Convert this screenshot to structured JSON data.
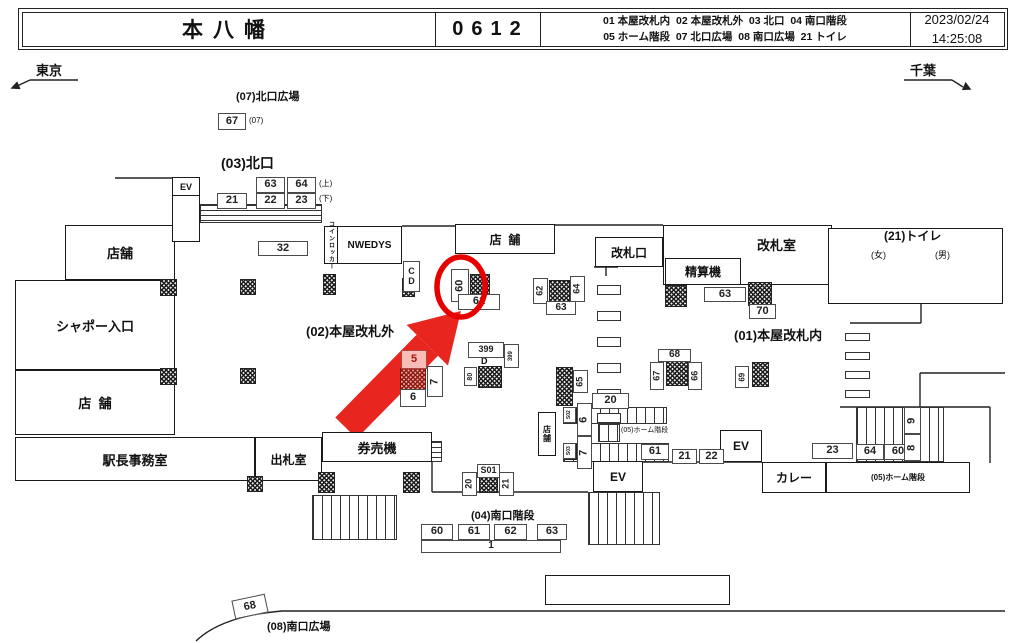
{
  "header": {
    "station": "本八幡",
    "code": "0612",
    "legend_line1": "01 本屋改札内  02 本屋改札外  03 北口  04 南口階段",
    "legend_line2": "05 ホーム階段  07 北口広場  08 南口広場  21 トイレ",
    "date": "2023/02/24",
    "time": "14:25:08"
  },
  "directions": {
    "left": "東京",
    "right": "千葉"
  },
  "colors": {
    "arrow_red": "#e8251f",
    "circle_red": "#e60000",
    "line": "#222222"
  },
  "map": {
    "labels": [
      {
        "n": "label-north-plaza",
        "t": "(07)北口広場",
        "x": 236,
        "y": 91,
        "s": 11,
        "b": 1
      },
      {
        "n": "label-sub-07",
        "t": "(07)",
        "x": 249,
        "y": 117,
        "s": 8
      },
      {
        "n": "label-north-exit",
        "t": "(03)北口",
        "x": 221,
        "y": 156,
        "s": 14,
        "b": 1
      },
      {
        "n": "label-upper",
        "t": "(上)",
        "x": 319,
        "y": 180,
        "s": 8
      },
      {
        "n": "label-lower",
        "t": "(下)",
        "x": 319,
        "y": 195,
        "s": 8
      },
      {
        "n": "label-outside-gates",
        "t": "(02)本屋改札外",
        "x": 306,
        "y": 325,
        "s": 13,
        "b": 1
      },
      {
        "n": "label-inside-gates",
        "t": "(01)本屋改札内",
        "x": 734,
        "y": 329,
        "s": 13,
        "b": 1
      },
      {
        "n": "label-toilet",
        "t": "(21)トイレ",
        "x": 884,
        "y": 230,
        "s": 12,
        "b": 1
      },
      {
        "n": "label-women",
        "t": "(女)",
        "x": 871,
        "y": 251,
        "s": 9
      },
      {
        "n": "label-men",
        "t": "(男)",
        "x": 935,
        "y": 251,
        "s": 9
      },
      {
        "n": "label-gate-room",
        "t": "改札室",
        "x": 757,
        "y": 239,
        "s": 13,
        "b": 1
      },
      {
        "n": "label-home-stairs-center",
        "t": "(05)ホーム階段",
        "x": 621,
        "y": 427,
        "s": 7,
        "bg": 1
      },
      {
        "n": "label-south-stairs",
        "t": "(04)南口階段",
        "x": 471,
        "y": 510,
        "s": 11,
        "b": 1
      },
      {
        "n": "label-south-plaza",
        "t": "(08)南口広場",
        "x": 267,
        "y": 621,
        "s": 11,
        "b": 1
      },
      {
        "n": "label-d",
        "t": "D",
        "x": 481,
        "y": 357,
        "s": 9,
        "b": 1
      }
    ],
    "rooms": [
      {
        "n": "room-shop-a",
        "t": "店舗",
        "x": 65,
        "y": 225,
        "w": 110,
        "h": 55,
        "s": 13
      },
      {
        "n": "room-chapeau-entrance",
        "t": "シャポー入口",
        "x": 15,
        "y": 280,
        "w": 160,
        "h": 90,
        "s": 13
      },
      {
        "n": "room-shop-b",
        "t": "店  舗",
        "x": 15,
        "y": 370,
        "w": 160,
        "h": 65,
        "s": 13
      },
      {
        "n": "room-stationmaster-office",
        "t": "駅長事務室",
        "x": 15,
        "y": 437,
        "w": 240,
        "h": 44,
        "s": 13
      },
      {
        "n": "room-ticket-window",
        "t": "出札室",
        "x": 255,
        "y": 437,
        "w": 67,
        "h": 44,
        "s": 12
      },
      {
        "n": "room-ticket-machines",
        "t": "券売機",
        "x": 322,
        "y": 432,
        "w": 110,
        "h": 30,
        "s": 13
      },
      {
        "n": "room-nwedys",
        "t": "NWEDYS",
        "x": 337,
        "y": 226,
        "w": 65,
        "h": 38,
        "s": 10
      },
      {
        "n": "room-shop-c",
        "t": "店  舗",
        "x": 455,
        "y": 224,
        "w": 100,
        "h": 30,
        "s": 12
      },
      {
        "n": "room-gate",
        "t": "改札口",
        "x": 595,
        "y": 237,
        "w": 68,
        "h": 30,
        "s": 12
      },
      {
        "n": "room-gate-office",
        "t": "",
        "x": 663,
        "y": 225,
        "w": 169,
        "h": 60
      },
      {
        "n": "room-fare-adjustment",
        "t": "精算機",
        "x": 665,
        "y": 258,
        "w": 76,
        "h": 27,
        "s": 12
      },
      {
        "n": "room-toilet",
        "t": "",
        "x": 828,
        "y": 228,
        "w": 175,
        "h": 76
      },
      {
        "n": "room-ev-north",
        "t": "EV",
        "x": 172,
        "y": 177,
        "w": 28,
        "h": 19,
        "s": 9
      },
      {
        "n": "room-ev-shaft",
        "t": "",
        "x": 172,
        "y": 195,
        "w": 28,
        "h": 47
      },
      {
        "n": "room-ev-center",
        "t": "EV",
        "x": 593,
        "y": 461,
        "w": 50,
        "h": 31,
        "s": 12
      },
      {
        "n": "room-ev-right",
        "t": "EV",
        "x": 720,
        "y": 430,
        "w": 42,
        "h": 32,
        "s": 12
      },
      {
        "n": "room-curry",
        "t": "カレー",
        "x": 762,
        "y": 462,
        "w": 64,
        "h": 31,
        "s": 12
      },
      {
        "n": "room-home-stairs-05",
        "t": "(05)ホーム階段",
        "x": 826,
        "y": 462,
        "w": 144,
        "h": 31,
        "s": 8
      },
      {
        "n": "room-south-rect",
        "t": "",
        "x": 545,
        "y": 575,
        "w": 185,
        "h": 30
      },
      {
        "n": "room-coin-locker",
        "t": "コインロッカー",
        "x": 324,
        "y": 226,
        "w": 14,
        "h": 38,
        "s": 6,
        "vl": 1
      },
      {
        "n": "room-shop-small",
        "t": "店舗",
        "x": 538,
        "y": 412,
        "w": 18,
        "h": 44,
        "s": 8,
        "vl": 1
      }
    ],
    "boxes": [
      {
        "t": "67",
        "x": 218,
        "y": 113,
        "w": 28,
        "h": 17
      },
      {
        "t": "63",
        "x": 256,
        "y": 177,
        "w": 29,
        "h": 16
      },
      {
        "t": "64",
        "x": 287,
        "y": 177,
        "w": 29,
        "h": 16
      },
      {
        "t": "21",
        "x": 217,
        "y": 193,
        "w": 30,
        "h": 16
      },
      {
        "t": "22",
        "x": 256,
        "y": 193,
        "w": 29,
        "h": 16
      },
      {
        "t": "23",
        "x": 287,
        "y": 193,
        "w": 29,
        "h": 16
      },
      {
        "t": "32",
        "x": 258,
        "y": 241,
        "w": 50,
        "h": 15
      },
      {
        "t": "C\nD",
        "x": 403,
        "y": 261,
        "w": 17,
        "h": 31,
        "s": 9
      },
      {
        "t": "60",
        "x": 451,
        "y": 269,
        "w": 18,
        "h": 33,
        "v": 1
      },
      {
        "t": "61",
        "x": 458,
        "y": 294,
        "w": 42,
        "h": 16
      },
      {
        "t": "399",
        "x": 468,
        "y": 342,
        "w": 36,
        "h": 16,
        "s": 9
      },
      {
        "t": "399",
        "x": 504,
        "y": 344,
        "w": 15,
        "h": 24,
        "v": 1,
        "s": 6
      },
      {
        "t": "80",
        "x": 464,
        "y": 367,
        "w": 13,
        "h": 19,
        "v": 1,
        "s": 7
      },
      {
        "t": "5",
        "x": 401,
        "y": 350,
        "w": 26,
        "h": 19,
        "red": 1
      },
      {
        "t": "7",
        "x": 427,
        "y": 366,
        "w": 16,
        "h": 31,
        "v": 1
      },
      {
        "t": "6",
        "x": 400,
        "y": 389,
        "w": 26,
        "h": 18
      },
      {
        "t": "62",
        "x": 533,
        "y": 278,
        "w": 15,
        "h": 26,
        "v": 1,
        "s": 9
      },
      {
        "t": "64",
        "x": 570,
        "y": 276,
        "w": 15,
        "h": 26,
        "v": 1,
        "s": 9
      },
      {
        "t": "63",
        "x": 546,
        "y": 301,
        "w": 30,
        "h": 14,
        "s": 10
      },
      {
        "t": "63",
        "x": 704,
        "y": 287,
        "w": 42,
        "h": 15
      },
      {
        "t": "70",
        "x": 749,
        "y": 304,
        "w": 27,
        "h": 15
      },
      {
        "t": "68",
        "x": 658,
        "y": 349,
        "w": 33,
        "h": 13,
        "s": 10
      },
      {
        "t": "67",
        "x": 650,
        "y": 362,
        "w": 14,
        "h": 28,
        "v": 1,
        "s": 9
      },
      {
        "t": "66",
        "x": 688,
        "y": 362,
        "w": 14,
        "h": 28,
        "v": 1,
        "s": 9
      },
      {
        "t": "69",
        "x": 735,
        "y": 366,
        "w": 14,
        "h": 22,
        "v": 1,
        "s": 8
      },
      {
        "t": "65",
        "x": 573,
        "y": 370,
        "w": 15,
        "h": 23,
        "v": 1,
        "s": 9
      },
      {
        "t": "20",
        "x": 592,
        "y": 393,
        "w": 37,
        "h": 16
      },
      {
        "t": "S02",
        "x": 563,
        "y": 407,
        "w": 13,
        "h": 16,
        "v": 1,
        "s": 5
      },
      {
        "t": "6",
        "x": 577,
        "y": 403,
        "w": 15,
        "h": 33,
        "v": 1
      },
      {
        "t": "S03",
        "x": 563,
        "y": 443,
        "w": 13,
        "h": 16,
        "v": 1,
        "s": 5
      },
      {
        "t": "7",
        "x": 577,
        "y": 436,
        "w": 15,
        "h": 33,
        "v": 1
      },
      {
        "t": "61",
        "x": 641,
        "y": 444,
        "w": 28,
        "h": 16
      },
      {
        "t": "21",
        "x": 672,
        "y": 449,
        "w": 25,
        "h": 15
      },
      {
        "t": "22",
        "x": 699,
        "y": 449,
        "w": 25,
        "h": 15
      },
      {
        "t": "23",
        "x": 812,
        "y": 443,
        "w": 41,
        "h": 16
      },
      {
        "t": "64",
        "x": 856,
        "y": 444,
        "w": 28,
        "h": 16
      },
      {
        "t": "60",
        "x": 884,
        "y": 444,
        "w": 28,
        "h": 16
      },
      {
        "t": "9",
        "x": 904,
        "y": 407,
        "w": 17,
        "h": 27,
        "v": 1
      },
      {
        "t": "8",
        "x": 904,
        "y": 434,
        "w": 17,
        "h": 27,
        "v": 1
      },
      {
        "t": "S01",
        "x": 477,
        "y": 464,
        "w": 23,
        "h": 14,
        "s": 9
      },
      {
        "t": "20",
        "x": 462,
        "y": 472,
        "w": 15,
        "h": 24,
        "v": 1,
        "s": 9
      },
      {
        "t": "21",
        "x": 499,
        "y": 472,
        "w": 15,
        "h": 24,
        "v": 1,
        "s": 9
      },
      {
        "t": "60",
        "x": 421,
        "y": 524,
        "w": 32,
        "h": 16
      },
      {
        "t": "61",
        "x": 458,
        "y": 524,
        "w": 32,
        "h": 16
      },
      {
        "t": "62",
        "x": 494,
        "y": 524,
        "w": 33,
        "h": 16
      },
      {
        "t": "63",
        "x": 537,
        "y": 524,
        "w": 30,
        "h": 16
      },
      {
        "t": "1",
        "x": 421,
        "y": 540,
        "w": 140,
        "h": 13,
        "s": 10
      },
      {
        "t": "68",
        "x": 233,
        "y": 597,
        "w": 34,
        "h": 19,
        "rot": -12
      }
    ],
    "hatches": [
      {
        "x": 160,
        "y": 279,
        "w": 17,
        "h": 17
      },
      {
        "x": 240,
        "y": 279,
        "w": 16,
        "h": 16
      },
      {
        "x": 323,
        "y": 274,
        "w": 13,
        "h": 21
      },
      {
        "x": 402,
        "y": 278,
        "w": 13,
        "h": 19
      },
      {
        "x": 160,
        "y": 368,
        "w": 17,
        "h": 17
      },
      {
        "x": 240,
        "y": 368,
        "w": 16,
        "h": 16
      },
      {
        "x": 247,
        "y": 476,
        "w": 16,
        "h": 16
      },
      {
        "x": 470,
        "y": 274,
        "w": 20,
        "h": 23
      },
      {
        "x": 478,
        "y": 366,
        "w": 24,
        "h": 22
      },
      {
        "x": 549,
        "y": 280,
        "w": 21,
        "h": 22
      },
      {
        "x": 665,
        "y": 285,
        "w": 22,
        "h": 22
      },
      {
        "x": 748,
        "y": 282,
        "w": 24,
        "h": 24
      },
      {
        "x": 666,
        "y": 361,
        "w": 22,
        "h": 25
      },
      {
        "x": 752,
        "y": 362,
        "w": 17,
        "h": 25
      },
      {
        "x": 556,
        "y": 367,
        "w": 17,
        "h": 39
      },
      {
        "x": 318,
        "y": 472,
        "w": 17,
        "h": 21
      },
      {
        "x": 403,
        "y": 472,
        "w": 17,
        "h": 21
      },
      {
        "x": 479,
        "y": 477,
        "w": 19,
        "h": 16
      },
      {
        "x": 565,
        "y": 408,
        "w": 12,
        "h": 15
      },
      {
        "x": 565,
        "y": 444,
        "w": 12,
        "h": 16
      },
      {
        "x": 400,
        "y": 368,
        "w": 26,
        "h": 22,
        "red": 1
      }
    ],
    "gates": [
      {
        "x": 597,
        "y": 285,
        "w": 24,
        "h": 10
      },
      {
        "x": 597,
        "y": 311,
        "w": 24,
        "h": 10
      },
      {
        "x": 597,
        "y": 337,
        "w": 24,
        "h": 10
      },
      {
        "x": 597,
        "y": 363,
        "w": 24,
        "h": 10
      },
      {
        "x": 597,
        "y": 389,
        "w": 24,
        "h": 10
      },
      {
        "x": 597,
        "y": 413,
        "w": 24,
        "h": 10
      },
      {
        "x": 845,
        "y": 333,
        "w": 25,
        "h": 8
      },
      {
        "x": 845,
        "y": 352,
        "w": 25,
        "h": 8
      },
      {
        "x": 845,
        "y": 371,
        "w": 25,
        "h": 8
      },
      {
        "x": 845,
        "y": 390,
        "w": 25,
        "h": 8
      }
    ],
    "stairs": [
      {
        "x": 200,
        "y": 204,
        "w": 122,
        "h": 19,
        "dir": "h"
      },
      {
        "x": 312,
        "y": 495,
        "w": 85,
        "h": 45,
        "dir": "v"
      },
      {
        "x": 588,
        "y": 492,
        "w": 72,
        "h": 53,
        "dir": "v"
      },
      {
        "x": 856,
        "y": 407,
        "w": 88,
        "h": 55,
        "dir": "v"
      },
      {
        "x": 563,
        "y": 407,
        "w": 104,
        "h": 17,
        "dir": "v"
      },
      {
        "x": 563,
        "y": 443,
        "w": 106,
        "h": 19,
        "dir": "v"
      },
      {
        "x": 598,
        "y": 424,
        "w": 22,
        "h": 18,
        "dir": "v"
      },
      {
        "x": 429,
        "y": 441,
        "w": 13,
        "h": 21,
        "dir": "h"
      }
    ],
    "walls": [
      [
        115,
        178,
        172,
        178
      ],
      [
        402,
        226,
        455,
        226
      ],
      [
        555,
        225,
        663,
        225
      ],
      [
        916,
        241,
        916,
        276
      ],
      [
        850,
        276,
        975,
        276
      ],
      [
        850,
        323,
        921,
        323
      ],
      [
        921,
        304,
        921,
        323
      ],
      [
        920,
        373,
        1005,
        373
      ],
      [
        920,
        373,
        920,
        407
      ],
      [
        840,
        407,
        990,
        407
      ],
      [
        990,
        407,
        990,
        463
      ],
      [
        432,
        462,
        432,
        492
      ],
      [
        432,
        492,
        588,
        492
      ],
      [
        643,
        462,
        762,
        462
      ],
      [
        594,
        267,
        618,
        267
      ],
      [
        606,
        267,
        606,
        276
      ]
    ],
    "highlight": {
      "circle": {
        "cx": 461,
        "cy": 287,
        "rx": 24,
        "ry": 30,
        "stroke_w": 5.5
      },
      "arrow": {
        "x": 346,
        "y": 428,
        "angle": -45.5,
        "body_len": 116,
        "body_w": 30,
        "head_len": 48,
        "head_w": 58
      }
    }
  }
}
